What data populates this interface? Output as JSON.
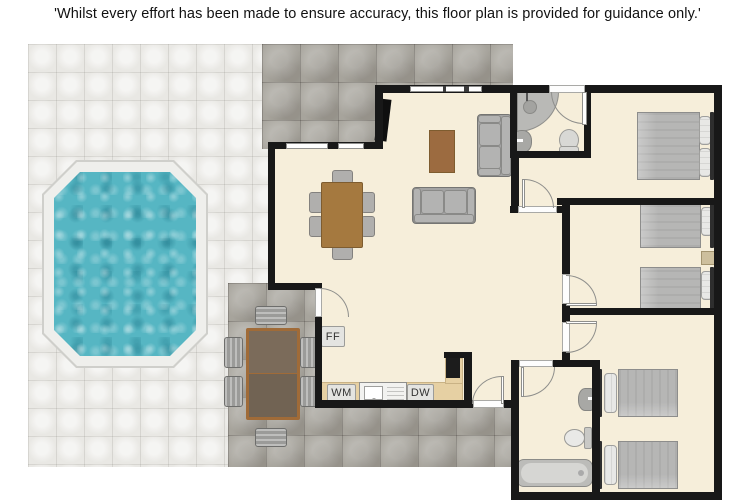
{
  "disclaimer": "'Whilst every effort has been made to ensure accuracy, this floor plan is provided for guidance only.'",
  "appliances": {
    "fridge_freezer": "FF",
    "washing_machine": "WM",
    "dishwasher": "DW"
  },
  "colors": {
    "floor": "#f6eeda",
    "wall": "#181818",
    "patio_light": "#e9e8e4",
    "patio_dark": "#a7a49c",
    "pool_water": "#56b6c3",
    "pool_deck": "#efefec",
    "counter": "#e6d0a3",
    "wood": "#a5793f"
  }
}
